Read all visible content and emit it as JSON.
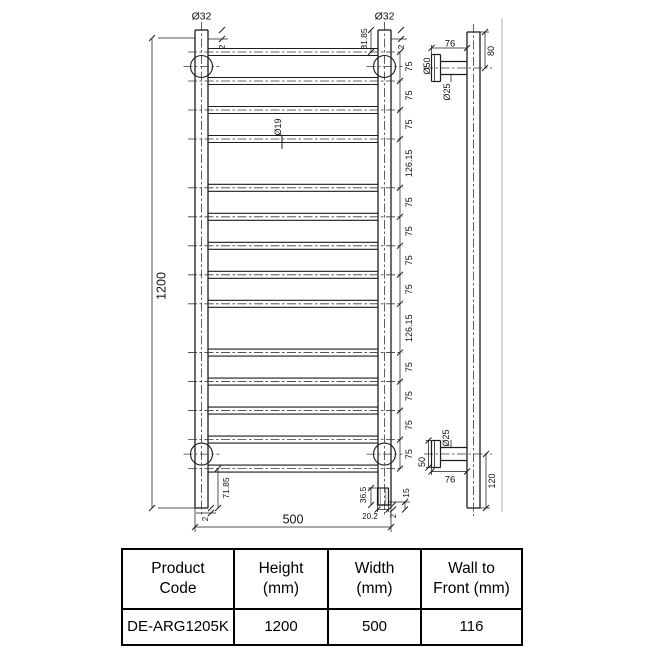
{
  "front_view": {
    "overall_height": "1200",
    "overall_width": "500",
    "tube_diameter": "Ø32",
    "rung_diameter": "Ø19",
    "top_offset": "31.85",
    "top_cap": "2",
    "bottom_offset": "71.85",
    "bottom_cap": "2",
    "rung_spacings": [
      "75",
      "75",
      "75",
      "126.15",
      "75",
      "75",
      "75",
      "75",
      "126.15",
      "75",
      "75",
      "75",
      "75"
    ],
    "spigot": {
      "height": "36.5",
      "diameter": "20.2",
      "cap": "2",
      "offset": "15"
    }
  },
  "side_view": {
    "bracket_length_top": "76",
    "bracket_length_bottom": "76",
    "top_bracket_offset": "80",
    "bottom_bracket_offset": "120",
    "flange_diameter": "Ø50",
    "flange_height": "50",
    "stem_diameter_top": "Ø25",
    "stem_diameter_bottom": "Ø25"
  },
  "table": {
    "headers": [
      [
        "Product",
        "Code"
      ],
      [
        "Height",
        "(mm)"
      ],
      [
        "Width",
        "(mm)"
      ],
      [
        "Wall to",
        "Front (mm)"
      ]
    ],
    "row": [
      "DE-ARG1205K",
      "1200",
      "500",
      "116"
    ]
  }
}
